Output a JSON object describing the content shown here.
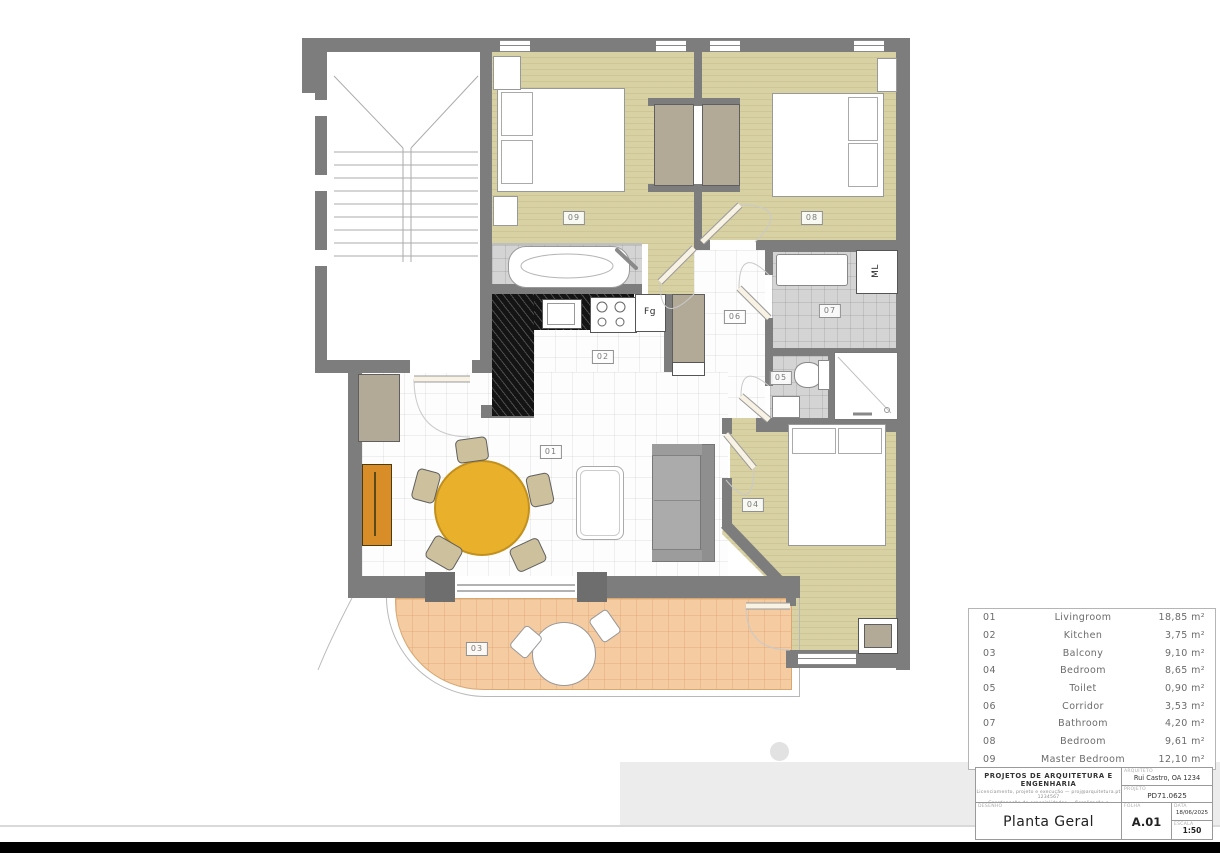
{
  "plan": {
    "room_labels": [
      {
        "text": "01",
        "x": 551,
        "y": 452
      },
      {
        "text": "02",
        "x": 603,
        "y": 357
      },
      {
        "text": "03",
        "x": 477,
        "y": 649
      },
      {
        "text": "04",
        "x": 753,
        "y": 505
      },
      {
        "text": "05",
        "x": 781,
        "y": 378
      },
      {
        "text": "06",
        "x": 735,
        "y": 317
      },
      {
        "text": "07",
        "x": 830,
        "y": 311
      },
      {
        "text": "08",
        "x": 812,
        "y": 218
      },
      {
        "text": "09",
        "x": 574,
        "y": 218
      }
    ],
    "annotations": {
      "washing_machine": "ML",
      "fridge": "Fg"
    }
  },
  "legend": {
    "rows": [
      {
        "code": "01",
        "name": "Livingroom",
        "area": "18,85 m²"
      },
      {
        "code": "02",
        "name": "Kitchen",
        "area": "3,75 m²"
      },
      {
        "code": "03",
        "name": "Balcony",
        "area": "9,10 m²"
      },
      {
        "code": "04",
        "name": "Bedroom",
        "area": "8,65 m²"
      },
      {
        "code": "05",
        "name": "Toilet",
        "area": "0,90 m²"
      },
      {
        "code": "06",
        "name": "Corridor",
        "area": "3,53 m²"
      },
      {
        "code": "07",
        "name": "Bathroom",
        "area": "4,20 m²"
      },
      {
        "code": "08",
        "name": "Bedroom",
        "area": "9,61 m²"
      },
      {
        "code": "09",
        "name": "Master Bedroom",
        "area": "12,10 m²"
      }
    ]
  },
  "title_block": {
    "company": "PROJETOS DE ARQUITETURA E ENGENHARIA",
    "company_line1": "Licenciamento, projeto e execução — proj@arquitetura.pt 1234567",
    "company_line2": "Coordenação de especialidades — fiscalização e acompanhamento de obra",
    "drawing_label": "DESENHO",
    "drawing_title": "Planta Geral",
    "architect_label": "ARQUITETO",
    "architect": "Rui Castro, OA 1234",
    "project_label": "PROJETO",
    "project_code": "PD71.0625",
    "sheet_label": "FOLHA",
    "sheet": "A.01",
    "date_label": "DATA",
    "date": "18/06/2025",
    "scale_label": "ESCALA",
    "scale": "1:50"
  }
}
